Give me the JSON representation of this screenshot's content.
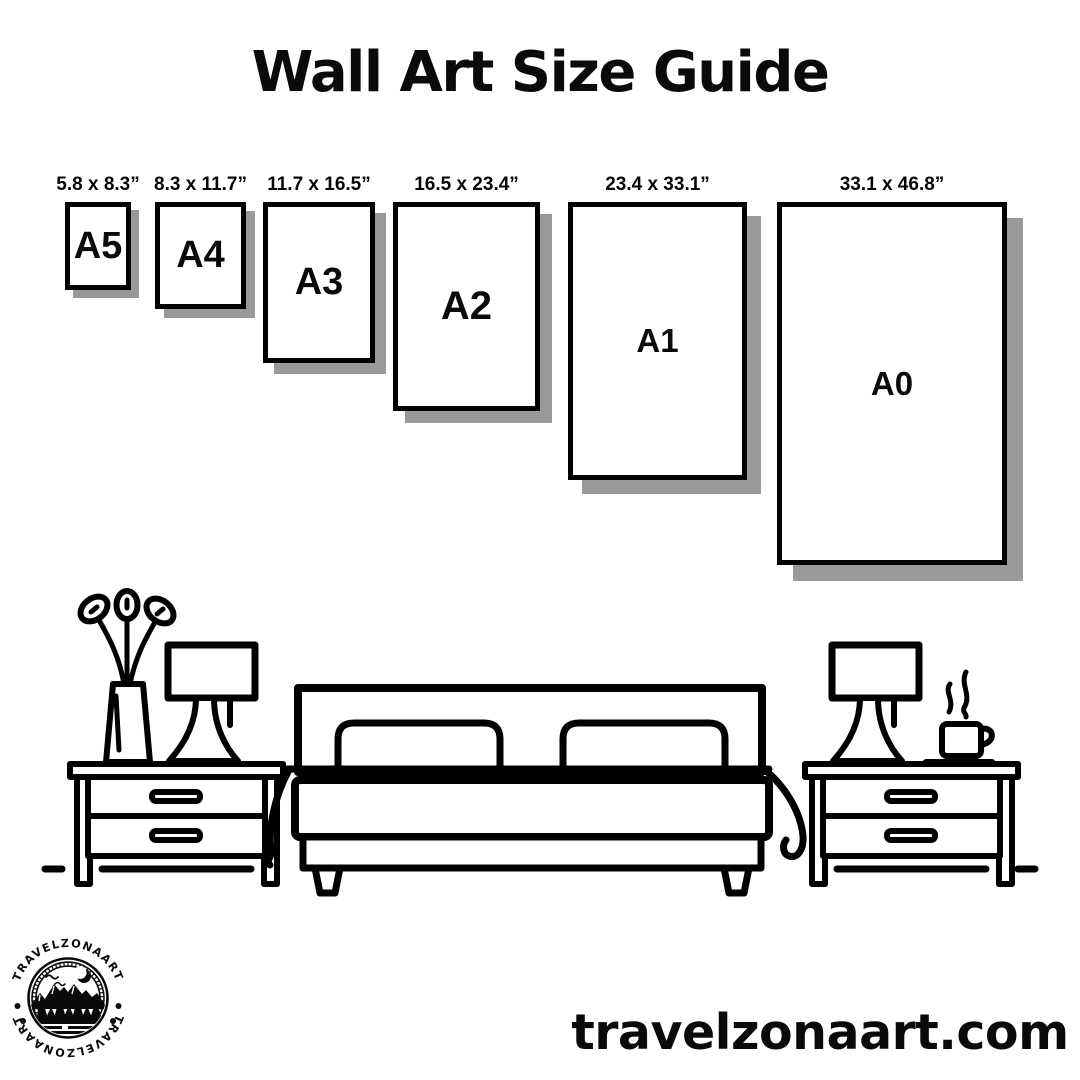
{
  "title": "Wall Art Size Guide",
  "sizes": {
    "items": [
      {
        "name": "A5",
        "dimensions": "5.8 x 8.3”"
      },
      {
        "name": "A4",
        "dimensions": "8.3 x 11.7”"
      },
      {
        "name": "A3",
        "dimensions": "11.7 x 16.5”"
      },
      {
        "name": "A2",
        "dimensions": "16.5 x 23.4”"
      },
      {
        "name": "A1",
        "dimensions": "23.4 x 33.1”"
      },
      {
        "name": "A0",
        "dimensions": "33.1 x 46.8”"
      }
    ]
  },
  "scene": {
    "icons": [
      "plant-vase-icon",
      "table-lamp-icon",
      "nightstand-icon",
      "double-bed-icon",
      "coffee-cup-icon"
    ]
  },
  "logo": {
    "arc_text_top": "TRAVELZONAART",
    "arc_text_bottom": "TRAVELZONAART"
  },
  "footer": {
    "website": "travelzonaart.com"
  },
  "colors": {
    "ink": "#000000",
    "shadow": "#999999",
    "background": "#ffffff"
  }
}
